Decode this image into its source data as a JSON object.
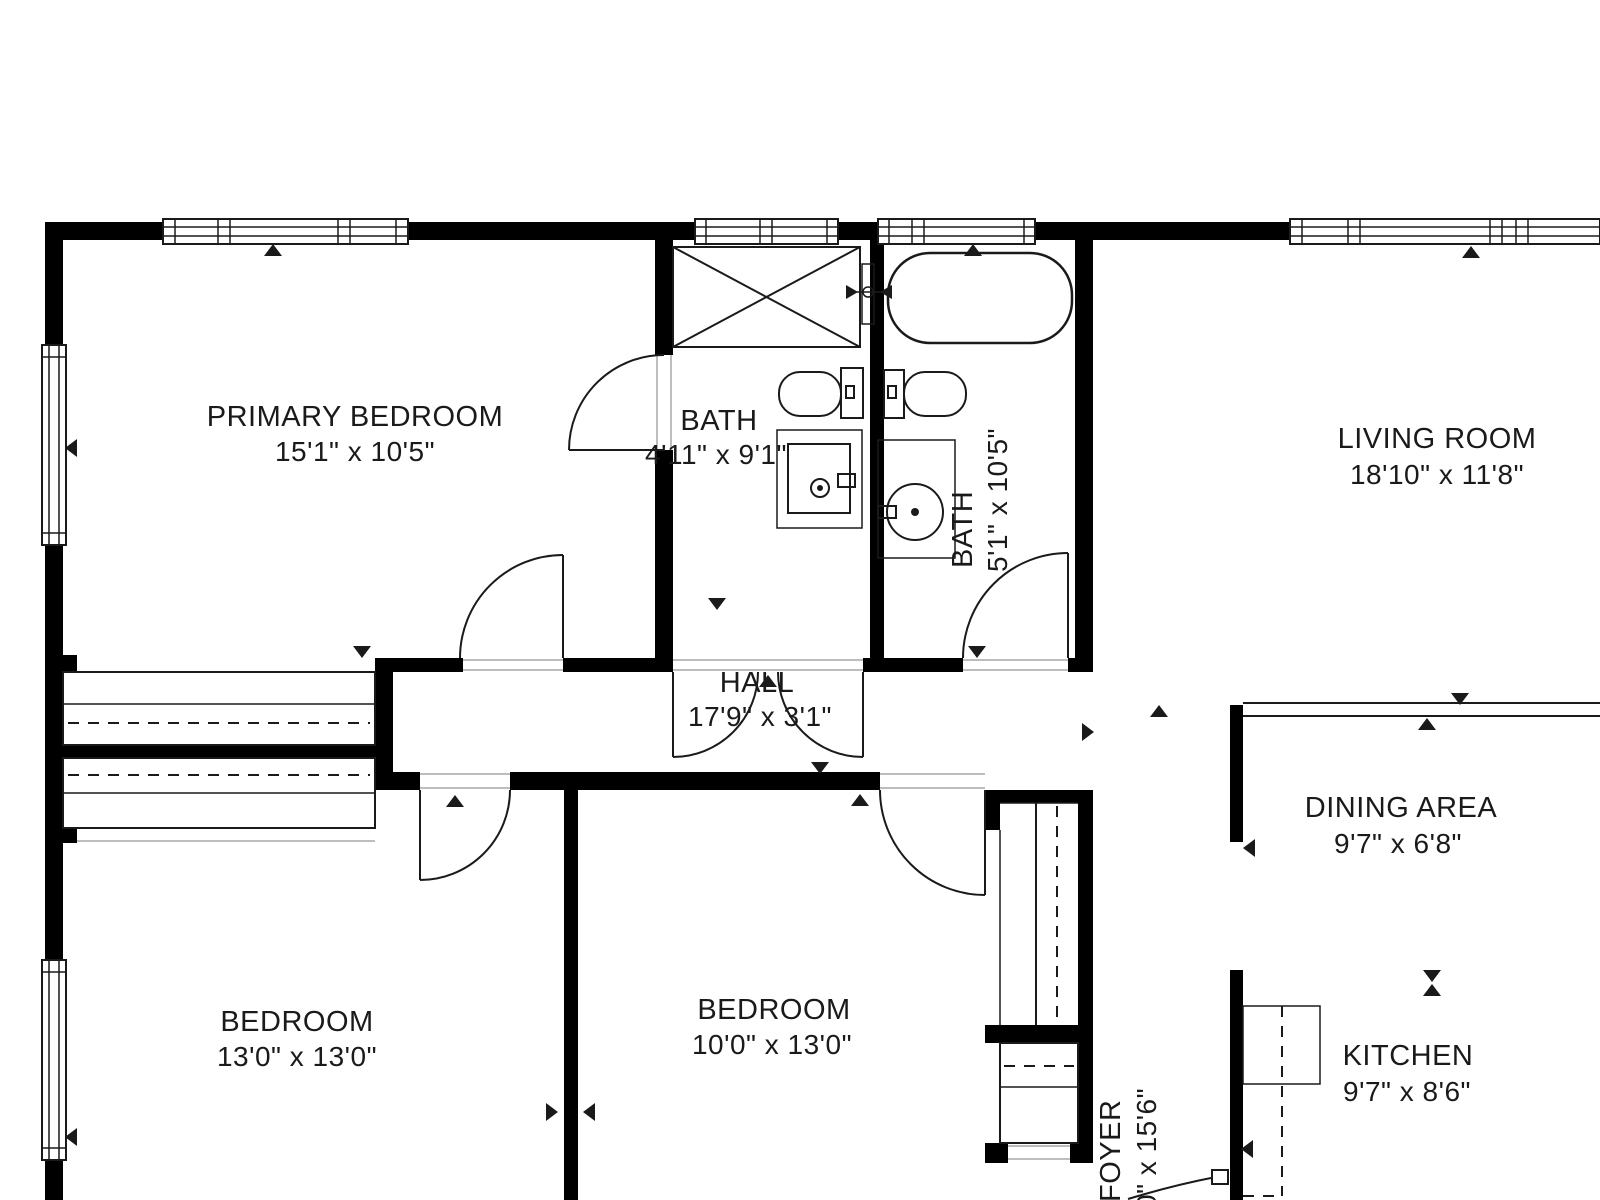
{
  "plan": {
    "type": "floor-plan",
    "rooms": [
      {
        "name": "PRIMARY BEDROOM",
        "dims": "15'1\" x 10'5\""
      },
      {
        "name": "BATH",
        "dims": "4'11\" x 9'1\""
      },
      {
        "name": "BATH",
        "dims": "5'1\" x 10'5\""
      },
      {
        "name": "LIVING ROOM",
        "dims": "18'10\" x 11'8\""
      },
      {
        "name": "HALL",
        "dims": "17'9\" x 3'1\""
      },
      {
        "name": "DINING AREA",
        "dims": "9'7\" x 6'8\""
      },
      {
        "name": "BEDROOM",
        "dims": "13'0\" x 13'0\""
      },
      {
        "name": "BEDROOM",
        "dims": "10'0\" x 13'0\""
      },
      {
        "name": "FOYER",
        "dims": "0\" x 15'6\""
      },
      {
        "name": "KITCHEN",
        "dims": "9'7\" x 8'6\""
      }
    ],
    "colors": {
      "wall": "#000000",
      "bg": "#ffffff",
      "ink": "#1a1a1a",
      "muted": "#bdbdbd"
    }
  }
}
